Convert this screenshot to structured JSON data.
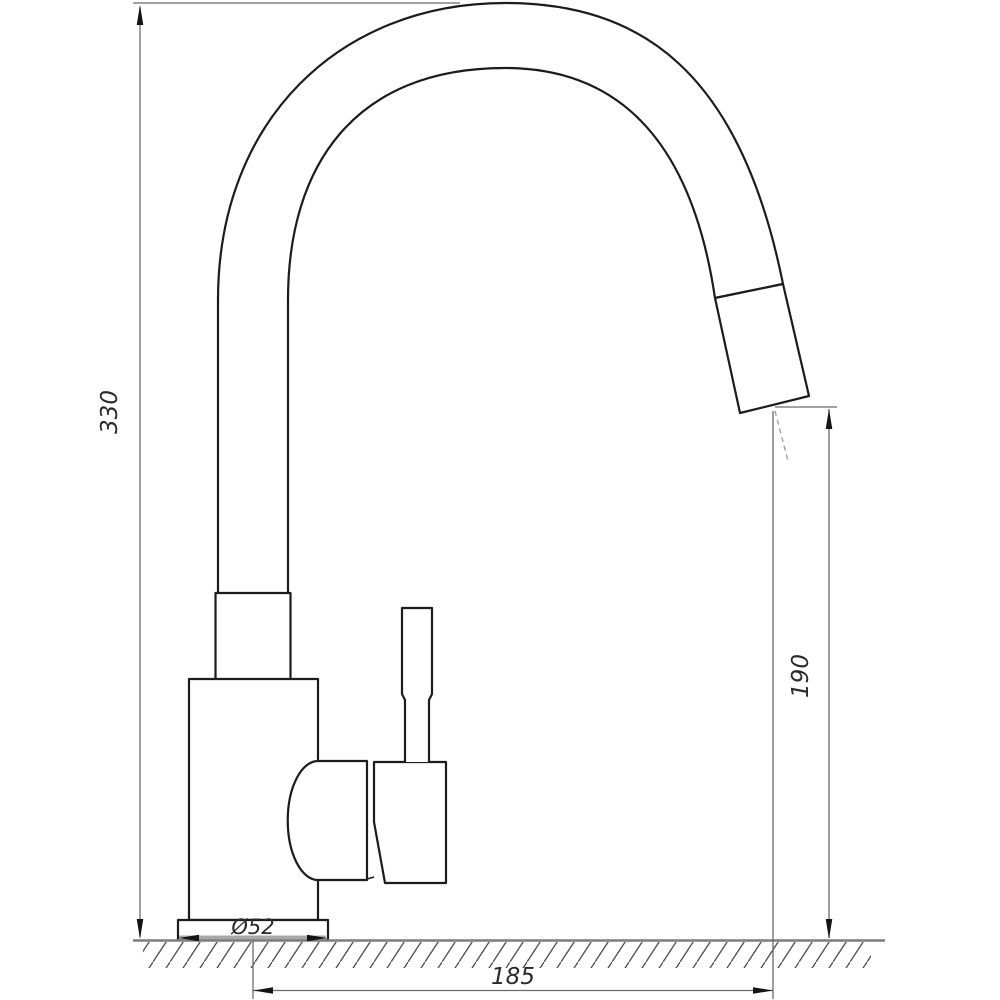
{
  "drawing": {
    "labels": {
      "total_height": "330",
      "outlet_height": "190",
      "spout_reach": "185",
      "base_diameter": "Ø52"
    },
    "colors": {
      "outline": "#1c1c1c",
      "dimension_line": "#6b6b6b",
      "arrow": "#141414",
      "ground_line": "#7d7d7d",
      "ground_pad": "#a8a8a8",
      "hatch": "#4f4f4f",
      "background": "#ffffff"
    }
  }
}
